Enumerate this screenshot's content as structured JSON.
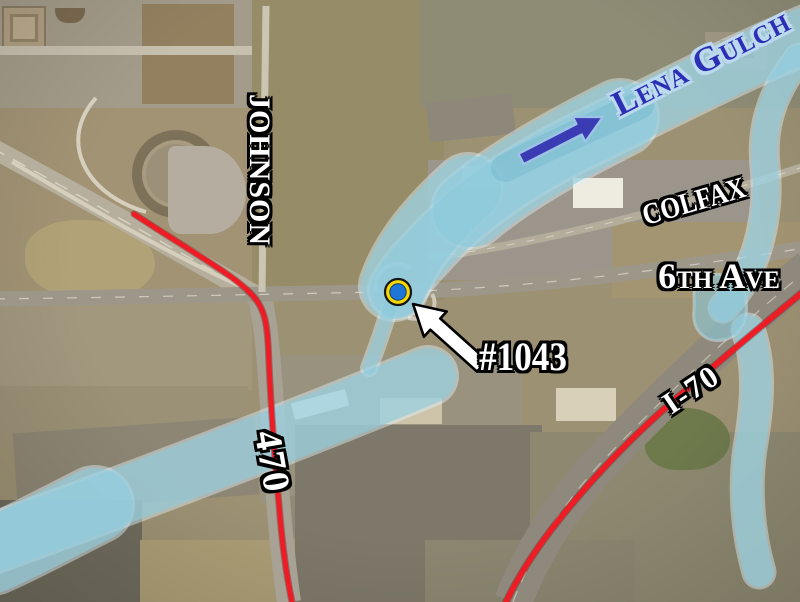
{
  "labels": {
    "stream": {
      "text": "Lena Gulch"
    },
    "johnson_street": {
      "text": "JOHNSON"
    },
    "colfax_avenue": {
      "text": "COLFAX"
    },
    "sixth_avenue": {
      "text": "6th Ave"
    },
    "route_470": {
      "text": "470"
    },
    "interstate_70": {
      "text": "I-70"
    },
    "site_number": {
      "text": "#1043"
    }
  },
  "marker": {
    "type": "site-location-dot",
    "site_ref": "#1043"
  },
  "overlay_colors": {
    "flood_zone_fill": "#8ccadc",
    "flood_zone_edge": "#dff2f8",
    "flood_zone_deep": "#6fb4c8",
    "route_line_red": "#ee1c24",
    "stream_label_fill": "#2b2fb4",
    "stream_label_outline": "#bcd9f0",
    "road_label_fill": "#ffffff",
    "road_label_outline": "#000000",
    "flow_arrow_fill": "#3b3bb4",
    "flow_arrow_edge": "#9cc2e6",
    "pointer_arrow_fill": "#ffffff",
    "pointer_arrow_edge": "#000000",
    "marker_ring": "#f5d800",
    "marker_center": "#1e76d6"
  }
}
